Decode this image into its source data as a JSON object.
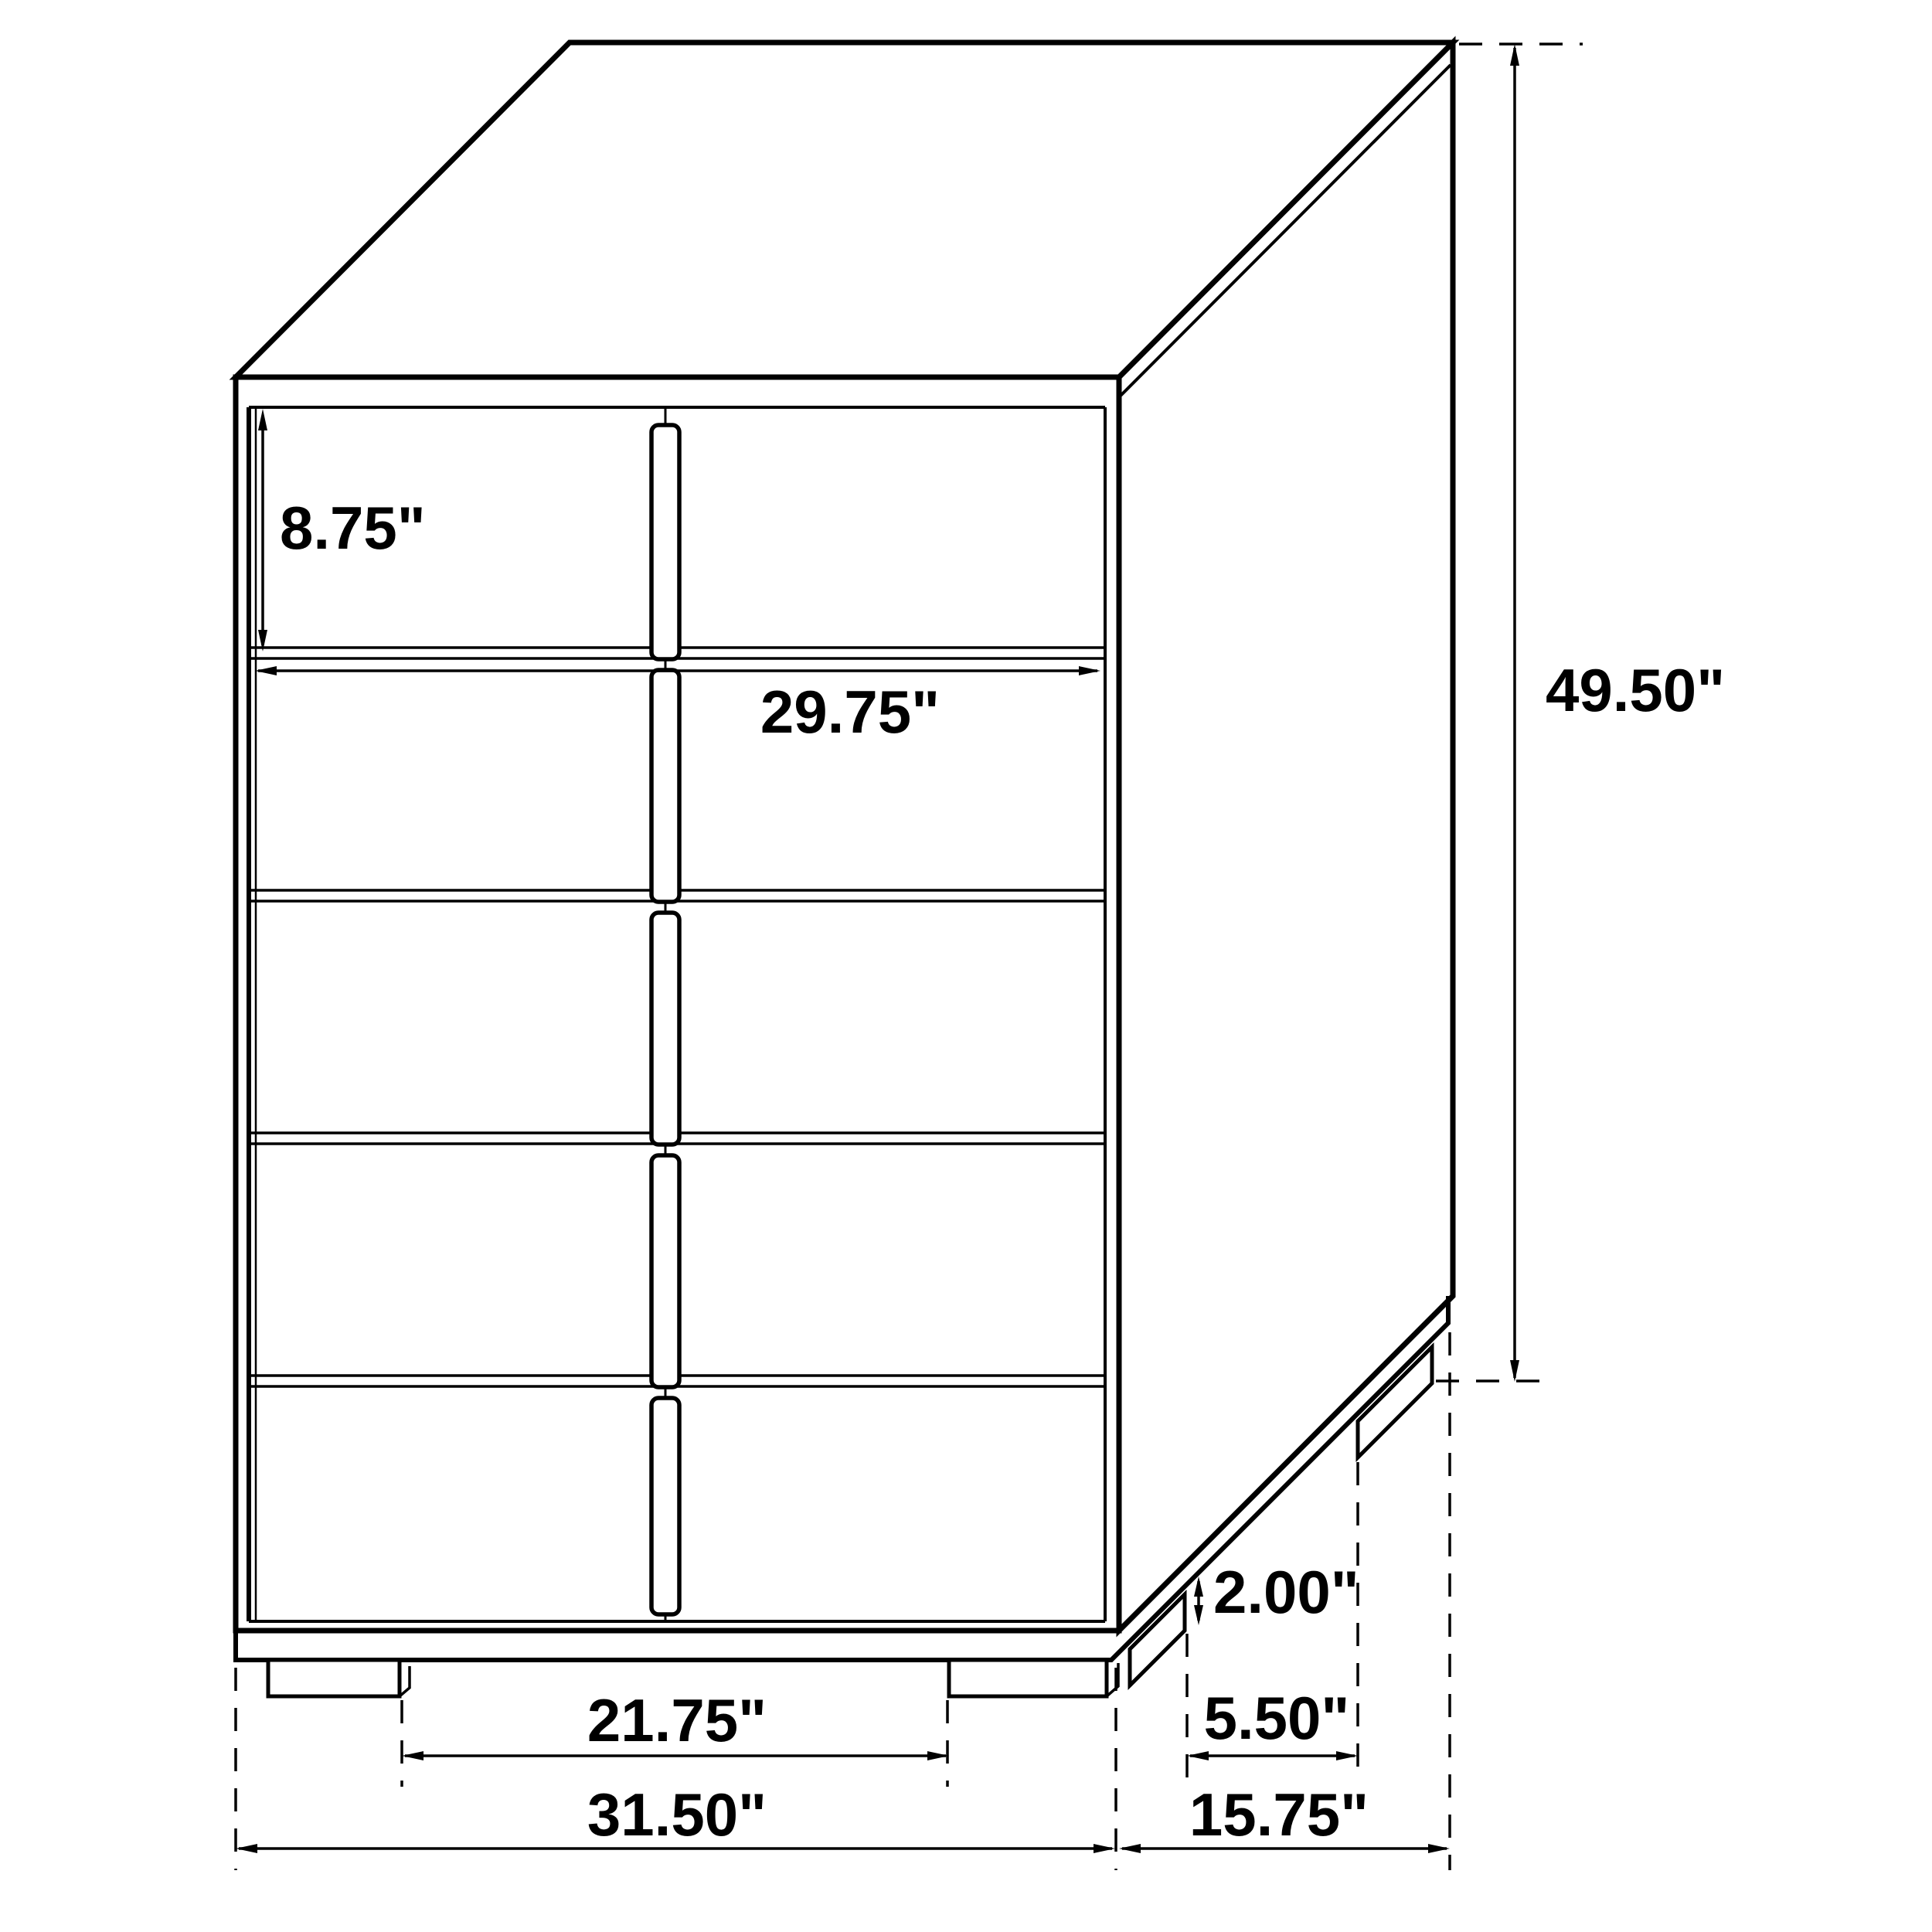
{
  "diagram": {
    "type": "furniture-dimension-drawing",
    "subject": "five-drawer chest, two-column drawer fronts, isometric view",
    "unit": "inches",
    "colors": {
      "line": "#000000",
      "background": "#ffffff",
      "text": "#000000"
    },
    "structure": {
      "drawer_rows": 5,
      "drawer_columns": 2,
      "handles": 5,
      "front_feet": 2,
      "side_feet": 2
    },
    "labels": {
      "drawer_front_height": "8.75\"",
      "drawer_width": "29.75\"",
      "overall_height": "49.50\"",
      "foot_height": "2.00\"",
      "side_foot_spacing": "5.50\"",
      "front_foot_spacing": "21.75\"",
      "overall_width": "31.50\"",
      "overall_depth": "15.75\""
    }
  }
}
